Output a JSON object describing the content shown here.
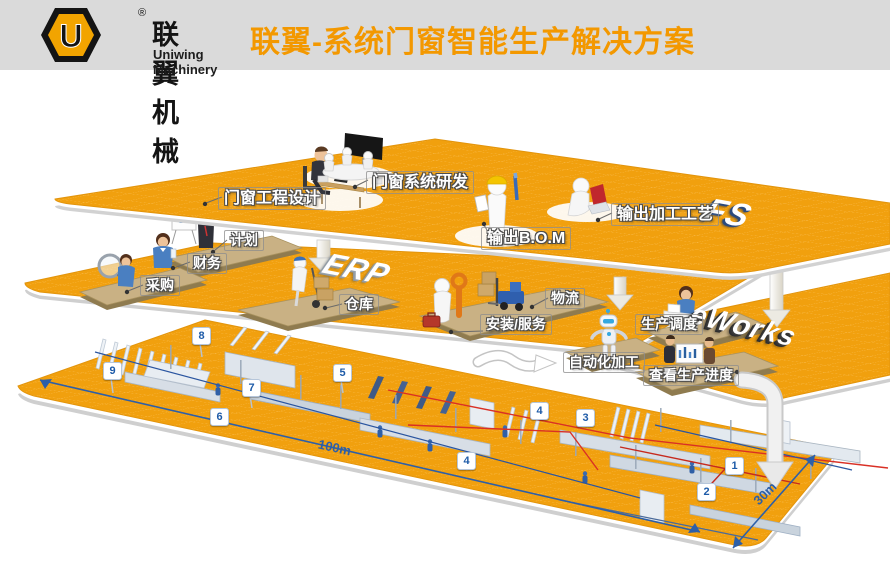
{
  "header": {
    "brand_cn": "联翼机械",
    "brand_en": "Uniwing Machinery",
    "registered_mark": "®",
    "title": "联翼-系统门窗智能生产解决方案"
  },
  "logos": {
    "fs": "FS",
    "erp": "ERP",
    "eworks": "eWorks"
  },
  "labels": {
    "design": "门窗工程设计",
    "rd": "门窗系统研发",
    "bom": "输出B.O.M",
    "craft": "输出加工工艺",
    "plan": "计划",
    "finance": "财务",
    "purchase": "采购",
    "warehouse": "仓库",
    "logistics": "物流",
    "install": "安装/服务",
    "schedule": "生产调度",
    "automation": "自动化加工",
    "progress": "查看生产进度"
  },
  "markers": [
    "1",
    "2",
    "3",
    "4",
    "4",
    "5",
    "6",
    "7",
    "8",
    "9"
  ],
  "dimensions": {
    "length": "100m",
    "width": "30m"
  },
  "colors": {
    "floor_orange": "#F1A00E",
    "title_orange": "#F39800",
    "platform_tan": "#C9B184",
    "badge_blue": "#1E5BA8",
    "dimension_blue": "#2D5FA8",
    "process_red": "#D93025"
  }
}
